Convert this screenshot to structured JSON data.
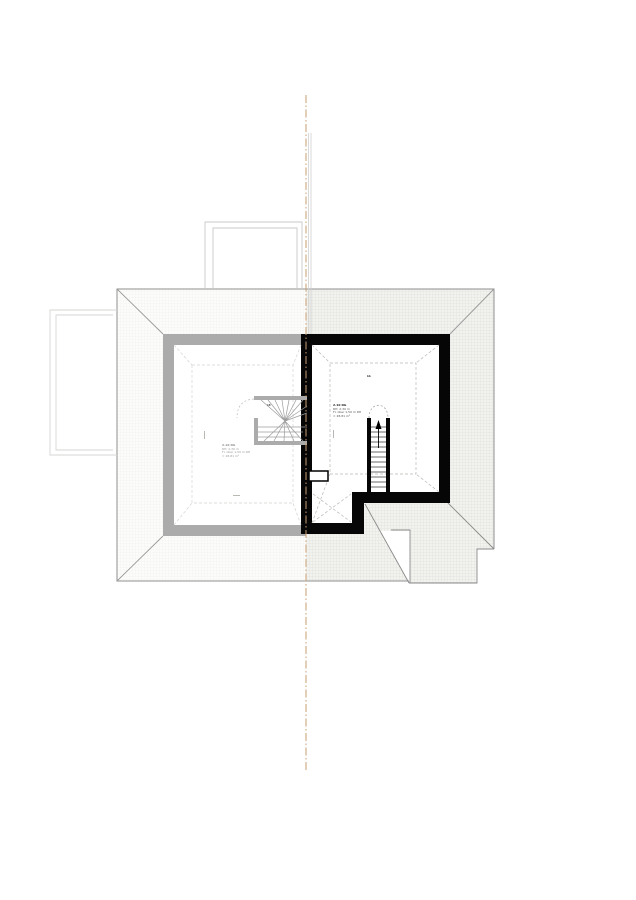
{
  "drawing_labels": {
    "left_room": {
      "lines": [
        "2.10 DG",
        "RH: 2,30 m",
        "Fl. über 1,50 m RH",
        "= 28,81 m²"
      ]
    },
    "right_room": {
      "lines": [
        "2.10 DG",
        "RH: 2,30 m",
        "Fl. über 1,50 m RH",
        "= 28,81 m²"
      ]
    },
    "section_marker": "bb",
    "stair_marker": "18"
  },
  "colors": {
    "centerline_orange": "#c79d72",
    "wall_existing_gray": "#ababab",
    "wall_new_black": "#060606",
    "roof_edge_gray": "#8f8f8f",
    "dashed_ceiling_gray": "#b8b8b3",
    "hatch_dense": "#d7d7d2",
    "hatch_light": "#efefec"
  }
}
